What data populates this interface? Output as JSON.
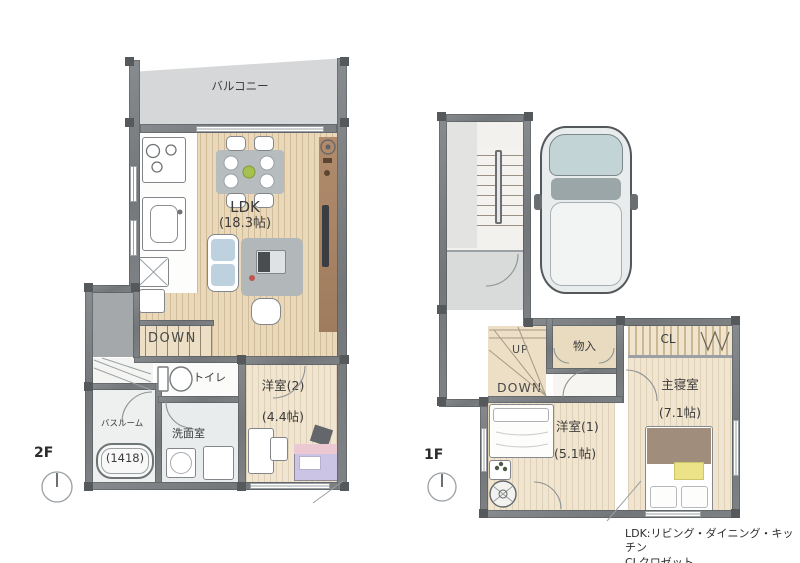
{
  "legend": {
    "line1": "LDK:リビング・ダイニング・キッチン",
    "line2": "CLクロゼット"
  },
  "floor2": {
    "floor_label": "2F",
    "balcony_label": "バルコニー",
    "ldk_name": "LDK",
    "ldk_size": "(18.3帖)",
    "stairs_down_label": "DOWN",
    "toilet_label": "トイレ",
    "bedroom2_name": "洋室(2)",
    "bedroom2_size": "(4.4帖)",
    "bathroom_name": "バスルーム",
    "bathroom_size": "(1418)",
    "washroom_label": "洗面室"
  },
  "floor1": {
    "floor_label": "1F",
    "stairs_up_label": "UP",
    "stairs_down_label": "DOWN",
    "storage_label": "物入",
    "closet_label": "CL",
    "master_bedroom_name": "主寝室",
    "master_bedroom_size": "(7.1帖)",
    "bedroom1_name": "洋室(1)",
    "bedroom1_size": "(5.1帖)"
  },
  "colors": {
    "wall": "#75797d",
    "wood_floor": "#e9d9ba",
    "balcony": "#d6d7d9",
    "stairs": "#ecdfc6",
    "bed2_pink": "#ecc9d2",
    "bed2_purple": "#cbc4e4",
    "master_blanket_brown": "#a18d7b",
    "cushion_yellow": "#ece388",
    "car_glass": "#c3d4d6"
  }
}
